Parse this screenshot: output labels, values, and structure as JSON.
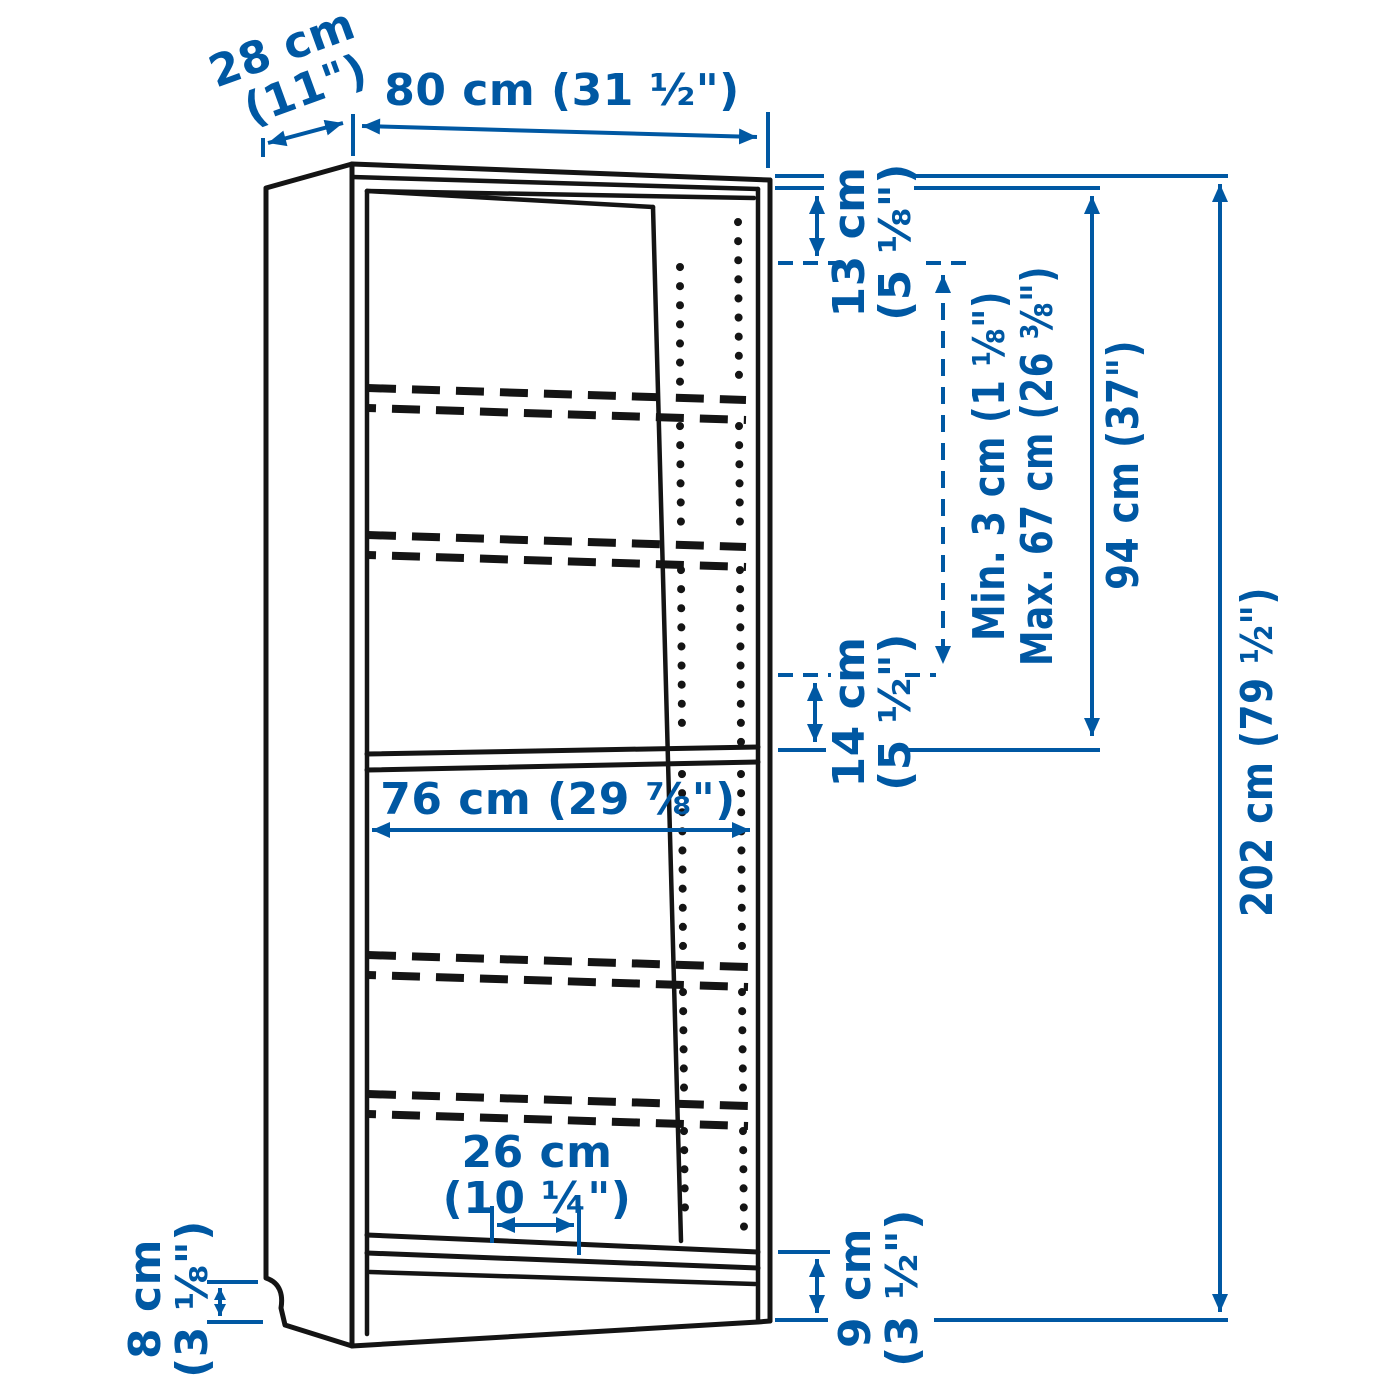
{
  "figure": {
    "title": "bookcase-dimension-diagram",
    "accent_color": "#0058a3",
    "line_color": "#141414",
    "background": "#ffffff"
  },
  "dimensions": {
    "depth": {
      "cm": "28 cm",
      "in": "(11\")"
    },
    "width": {
      "label": "80 cm (31 ½\")"
    },
    "top_gap": {
      "cm": "13 cm",
      "in": "(5 ⅛\")"
    },
    "shelf_min": {
      "label": "Min. 3 cm (1 ⅛\")"
    },
    "shelf_max": {
      "label": "Max. 67 cm (26 ⅜\")"
    },
    "upper_height": {
      "label": "94 cm (37\")"
    },
    "total_height": {
      "label": "202 cm (79 ½\")"
    },
    "mid_gap": {
      "cm": "14 cm",
      "in": "(5 ½\")"
    },
    "interior_width": {
      "label": "76 cm (29 ⅞\")"
    },
    "bottom_depth": {
      "cm": "26 cm",
      "in": "(10 ¼\")"
    },
    "plinth_left": {
      "cm": "8 cm",
      "in": "(3 ⅛\")"
    },
    "plinth_right": {
      "cm": "9 cm",
      "in": "(3 ½\")"
    }
  }
}
